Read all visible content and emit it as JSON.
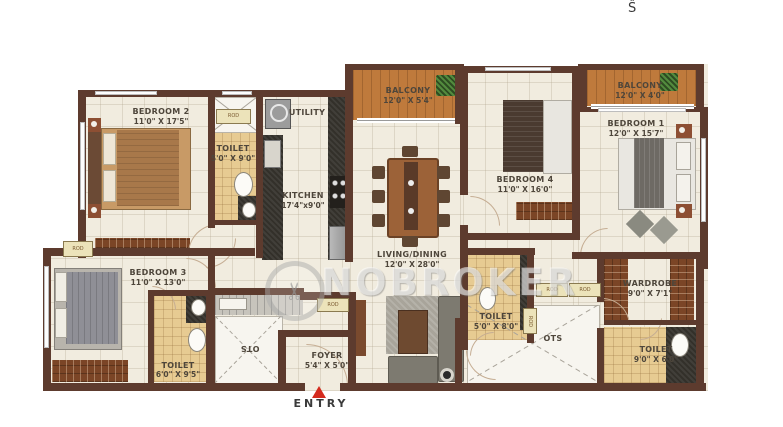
{
  "compass": {
    "label": "Ŝ"
  },
  "watermark": {
    "brand": "NOBROKER",
    "icon": "scissors-icon"
  },
  "entry": {
    "label": "ENTRY"
  },
  "rod_label": "ROD",
  "rooms": {
    "bedroom2": {
      "name": "BEDROOM 2",
      "dims": "11'0\" X 17'5\""
    },
    "toilet2": {
      "name": "TOILET",
      "dims": "5'0\" X 9'0\""
    },
    "utility": {
      "name": "UTILITY"
    },
    "kitchen": {
      "name": "KITCHEN",
      "dims": "17'4\"x9'0\""
    },
    "balcony_center": {
      "name": "BALCONY",
      "dims": "12'0\" X 5'4\""
    },
    "living_dining": {
      "name": "LIVING/DINING",
      "dims": "12'0\" X 28'0\""
    },
    "bedroom4": {
      "name": "BEDROOM 4",
      "dims": "11'0\" X 16'0\""
    },
    "balcony_right": {
      "name": "BALCONY",
      "dims": "12'0\" X 4'0\""
    },
    "bedroom1": {
      "name": "BEDROOM 1",
      "dims": "12'0\" X 15'7\""
    },
    "bedroom3": {
      "name": "BEDROOM 3",
      "dims": "11'0\" X 13'0\""
    },
    "toilet3": {
      "name": "TOILET",
      "dims": "6'0\" X 9'5\""
    },
    "ots_left": {
      "name": "OTS"
    },
    "foyer": {
      "name": "FOYER",
      "dims": "5'4\" X 5'0\""
    },
    "toilet_center": {
      "name": "TOILET",
      "dims": "5'0\" X 8'0\""
    },
    "ots_right": {
      "name": "OTS"
    },
    "wardrobe": {
      "name": "WARDROBE",
      "dims": "9'0\" X 7'1\""
    },
    "toilet1": {
      "name": "TOILET",
      "dims": "9'0\" X 6'0\""
    }
  },
  "colors": {
    "wall": "#5d3b2e",
    "floor": "#f1ecdf",
    "toilet_floor": "#e7cb92",
    "balcony": "#bf7a3c",
    "counter": "#33302a",
    "wardrobe_wood": "#7b4526",
    "entry_arrow": "#d42b1e",
    "label_text": "#4e463b"
  }
}
